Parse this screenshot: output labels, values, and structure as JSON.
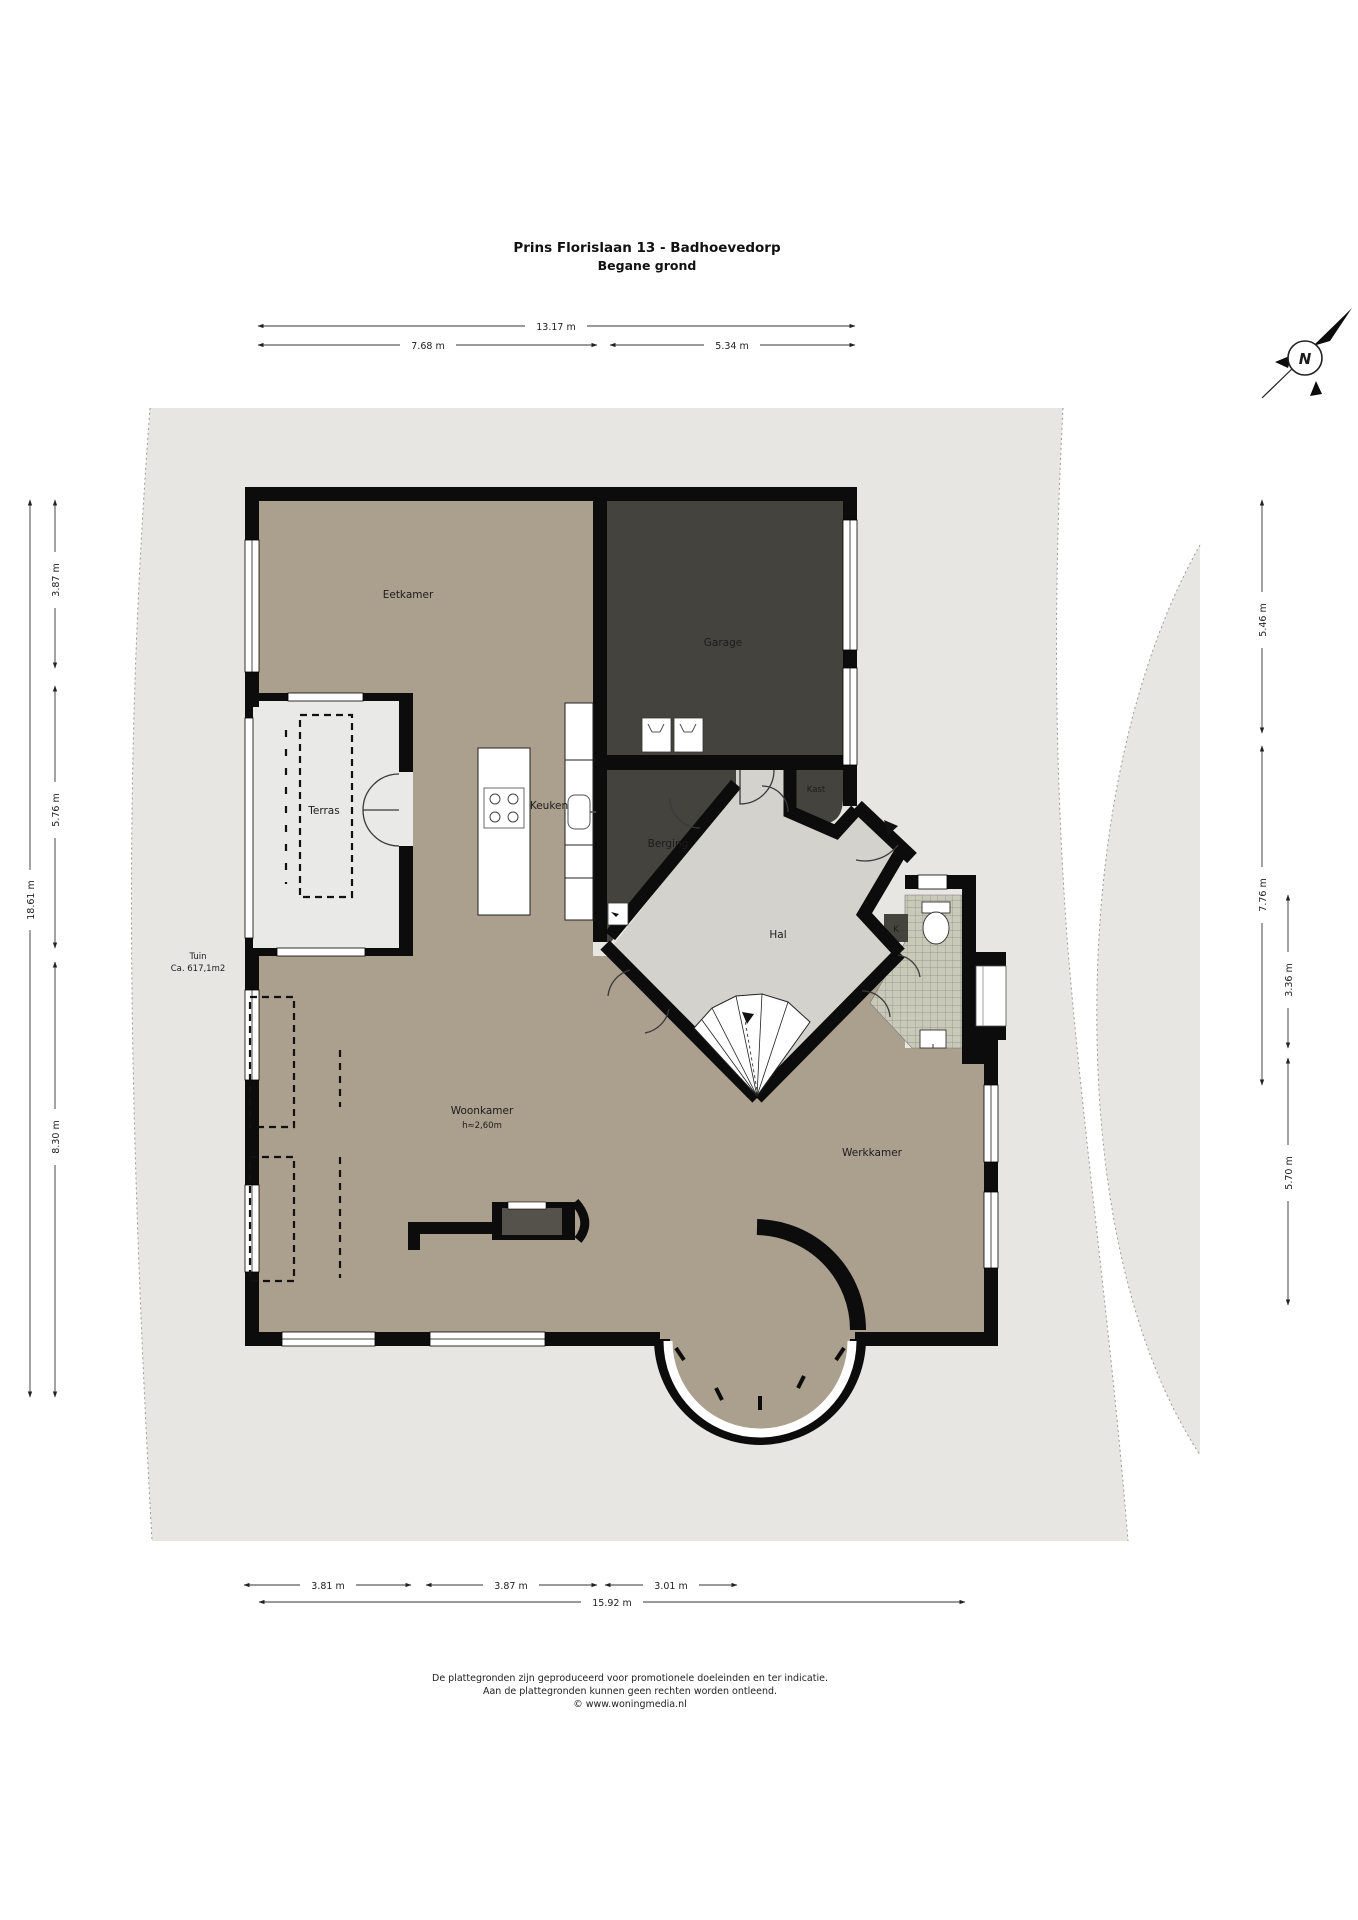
{
  "title": {
    "line1": "Prins Florislaan 13 - Badhoevedorp",
    "line2": "Begane grond"
  },
  "compass": {
    "letter": "N"
  },
  "rooms": {
    "eetkamer": "Eetkamer",
    "garage": "Garage",
    "terras": "Terras",
    "keuken": "Keuken",
    "berging": "Berging",
    "kast": "Kast",
    "hal": "Hal",
    "k_closet": "K",
    "tuin": "Tuin",
    "tuin_area": "Ca. 617,1m2",
    "woonkamer": "Woonkamer",
    "woonkamer_height": "h≈2,60m",
    "werkkamer": "Werkkamer"
  },
  "dimensions": {
    "top_total": "13.17 m",
    "top_left": "7.68 m",
    "top_right": "5.34 m",
    "left_outer": "18.61 m",
    "left_a": "3.87 m",
    "left_b": "5.76 m",
    "left_c": "8.30 m",
    "right_a": "5.46 m",
    "right_b": "7.76 m",
    "right_c": "3.36 m",
    "right_d": "5.70 m",
    "bottom_a": "3.81 m",
    "bottom_b": "3.87 m",
    "bottom_c": "3.01 m",
    "bottom_total": "15.92 m"
  },
  "footer": {
    "line1": "De plattegronden zijn geproduceerd voor promotionele doeleinden en ter indicatie.",
    "line2": "Aan de plattegronden kunnen geen rechten worden ontleend.",
    "line3": "© www.woningmedia.nl"
  },
  "colors": {
    "floor_tan": "#ab9f8d",
    "floor_dark": "#45433d",
    "hal_floor": "#d3d2cc",
    "terras_floor": "#e9e9e7",
    "plot_gray": "#e7e6e3",
    "wall_black": "#0c0c0c",
    "tile": "#c9c9ba"
  }
}
